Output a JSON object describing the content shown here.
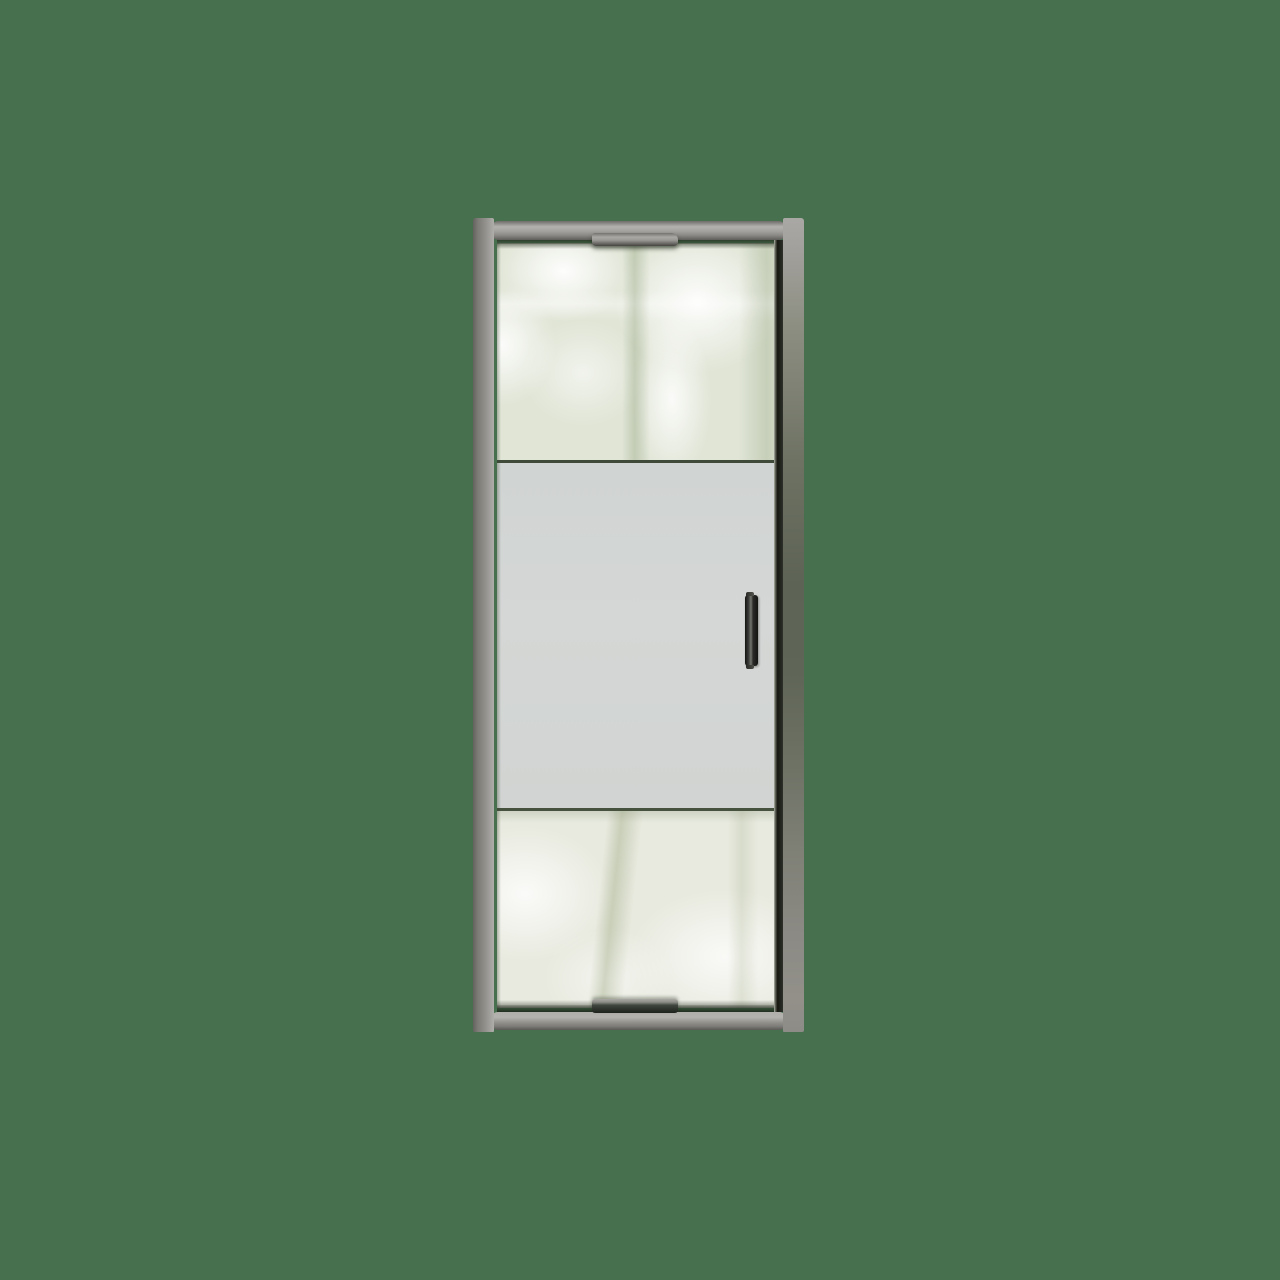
{
  "scene": {
    "type": "product-render",
    "subject": "framed pivot shower door with frosted privacy band and vertical handle",
    "background": "solid green backdrop",
    "text_content": "none"
  },
  "colors": {
    "bg": "#47704f",
    "frame-rail-light": "#b4b2ae",
    "frame-rail-dark": "#6e6d69",
    "frame-rail-shadow": "#5f5e5a",
    "post-left-dark": "#63625e",
    "post-left-mid": "#908e89",
    "post-left-edge": "#b0aeab",
    "post-right-top": "#aaa8a4",
    "post-right-green": "#5d6355",
    "post-right-bottom": "#929089",
    "glass-clear-top": "#e0e5d6",
    "glass-clear-bottom": "#e8eadf",
    "glass-frosted": "#d4d7d5",
    "glass-frosted-hi": "#d0d4d3",
    "glass-frosted-lo": "#d1d4d2",
    "divider-green": "#3f4a39",
    "divider-green-2": "#46513e",
    "seal-black": "#15170f",
    "handle-black": "#141512",
    "handle-sheen": "#74756f",
    "bracket-light": "#aaa8a4",
    "bracket-dark": "#45443f"
  }
}
